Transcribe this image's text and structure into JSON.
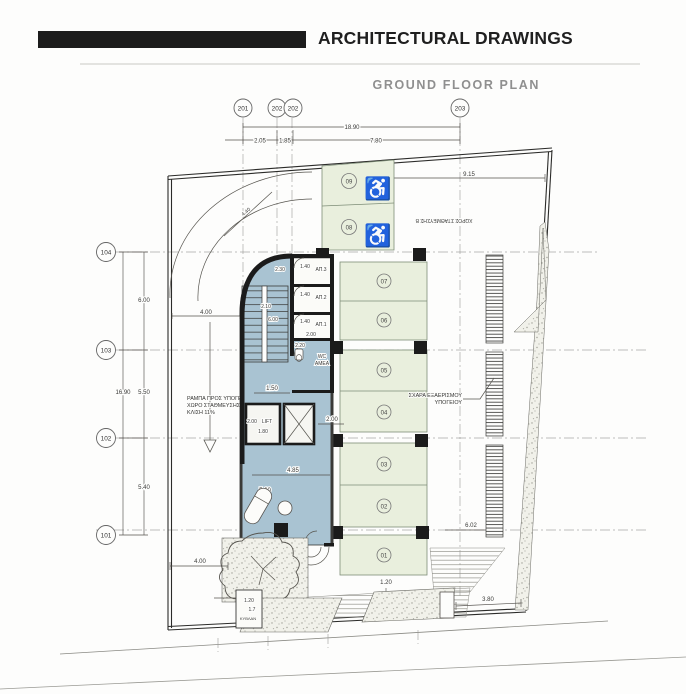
{
  "header": {
    "title": "ARCHITECTURAL DRAWINGS",
    "subtitle": "GROUND FLOOR PLAN"
  },
  "grid": {
    "top_bubbles": [
      "201",
      "202",
      "202",
      "203"
    ],
    "left_bubbles": [
      "104",
      "103",
      "102",
      "101"
    ]
  },
  "dims": {
    "top_overall": "18.90",
    "top_a": "2.05",
    "top_b": "1.85",
    "top_c": "7.80",
    "left_overall": "16.90",
    "left_a": "6.00",
    "left_b": "5.50",
    "left_c": "5.40",
    "top_right": "9.15",
    "ramp_width": "4.00",
    "ramp_diag": "4.40",
    "stair_a": "2.30",
    "stair_b": "2.10",
    "stair_c": "6.00",
    "room_w": "1.40",
    "wc_w": "2.00",
    "wc_d": "2.20",
    "corridor": "1.50",
    "lift_w": "2.00",
    "lift_d": "1.80",
    "shaft_w": "2.00",
    "lobby_w": "4.85",
    "lobby_d": "5.60",
    "stall_w": "1.20",
    "vent": "6.02",
    "entry": "3.80",
    "front": "4.00",
    "walk": "1.20",
    "box_a": "1.20",
    "box_b": "1.7"
  },
  "labels": {
    "parking_area": "ΧΩΡΟΣ ΣΤΑΘΜΕΥΣΗΣ Β",
    "ramp_1": "ΡΑΜΠΑ ΠΡΟΣ ΥΠΟΓΕΙΟ",
    "ramp_2": "ΧΩΡΟ ΣΤΑΘΜΕΥΣΗΣ",
    "ramp_3": "ΚΛΙΣΗ 11%",
    "vent_1": "ΣΧΑΡΑ ΕΞΑΕΡΙΣΜΟΥ",
    "vent_2": "ΥΠΟΓΕΙΟΥ",
    "wc_1": "WC",
    "wc_2": "ΑΜΕΑ",
    "lift": "LIFT",
    "rooms": [
      "ΑΠ.3",
      "ΑΠ.2",
      "ΑΠ.1"
    ],
    "entry_box": "ΚΥΒΛΑΝ"
  },
  "parking": {
    "stalls": [
      "09",
      "08",
      "07",
      "06",
      "05",
      "04",
      "03",
      "02",
      "01"
    ],
    "wheelchair_icon": "♿"
  },
  "colors": {
    "stall_fill": "#e9efdd",
    "lobby_fill": "#a9c3d2",
    "wall": "#1b1b1b",
    "paper": "#fdfdfc"
  }
}
